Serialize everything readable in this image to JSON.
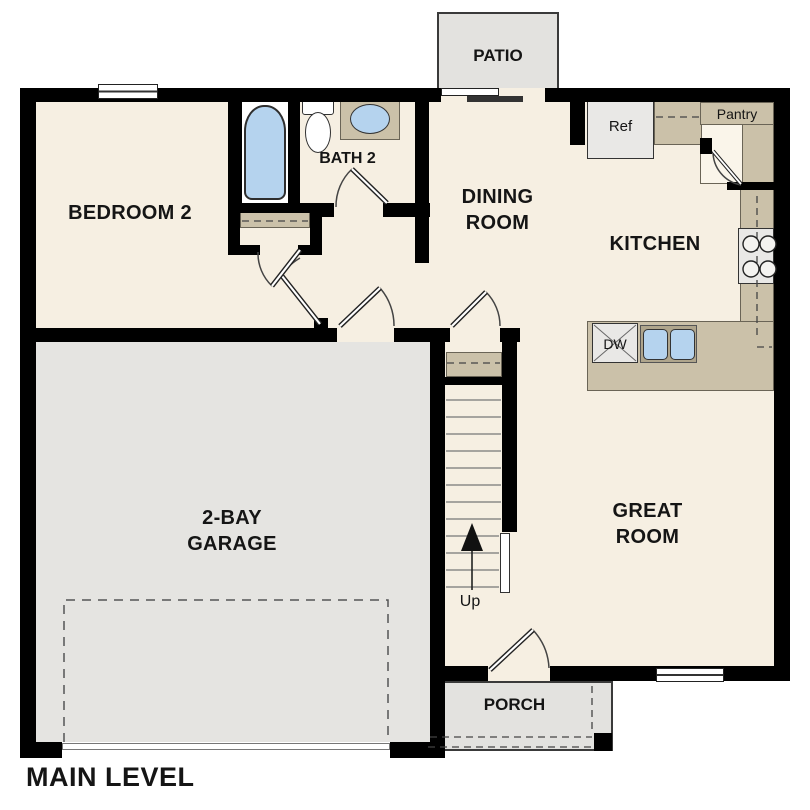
{
  "plan": {
    "level_label": "MAIN LEVEL",
    "rooms": {
      "bedroom2": "BEDROOM 2",
      "bath2": "BATH 2",
      "dining_line1": "DINING",
      "dining_line2": "ROOM",
      "kitchen": "KITCHEN",
      "great_line1": "GREAT",
      "great_line2": "ROOM",
      "garage_line1": "2-BAY",
      "garage_line2": "GARAGE",
      "patio": "PATIO",
      "porch": "PORCH"
    },
    "fixtures": {
      "ref": "Ref",
      "pantry": "Pantry",
      "dw": "DW",
      "up": "Up"
    },
    "colors": {
      "floor": "#F6EFE2",
      "wall": "#000000",
      "garage": "#E5E4E1",
      "outdoor": "#E3E2DF",
      "counter": "#CBC1A9",
      "blue": "#B5D3EE",
      "appliance": "#E9E8E6"
    }
  }
}
